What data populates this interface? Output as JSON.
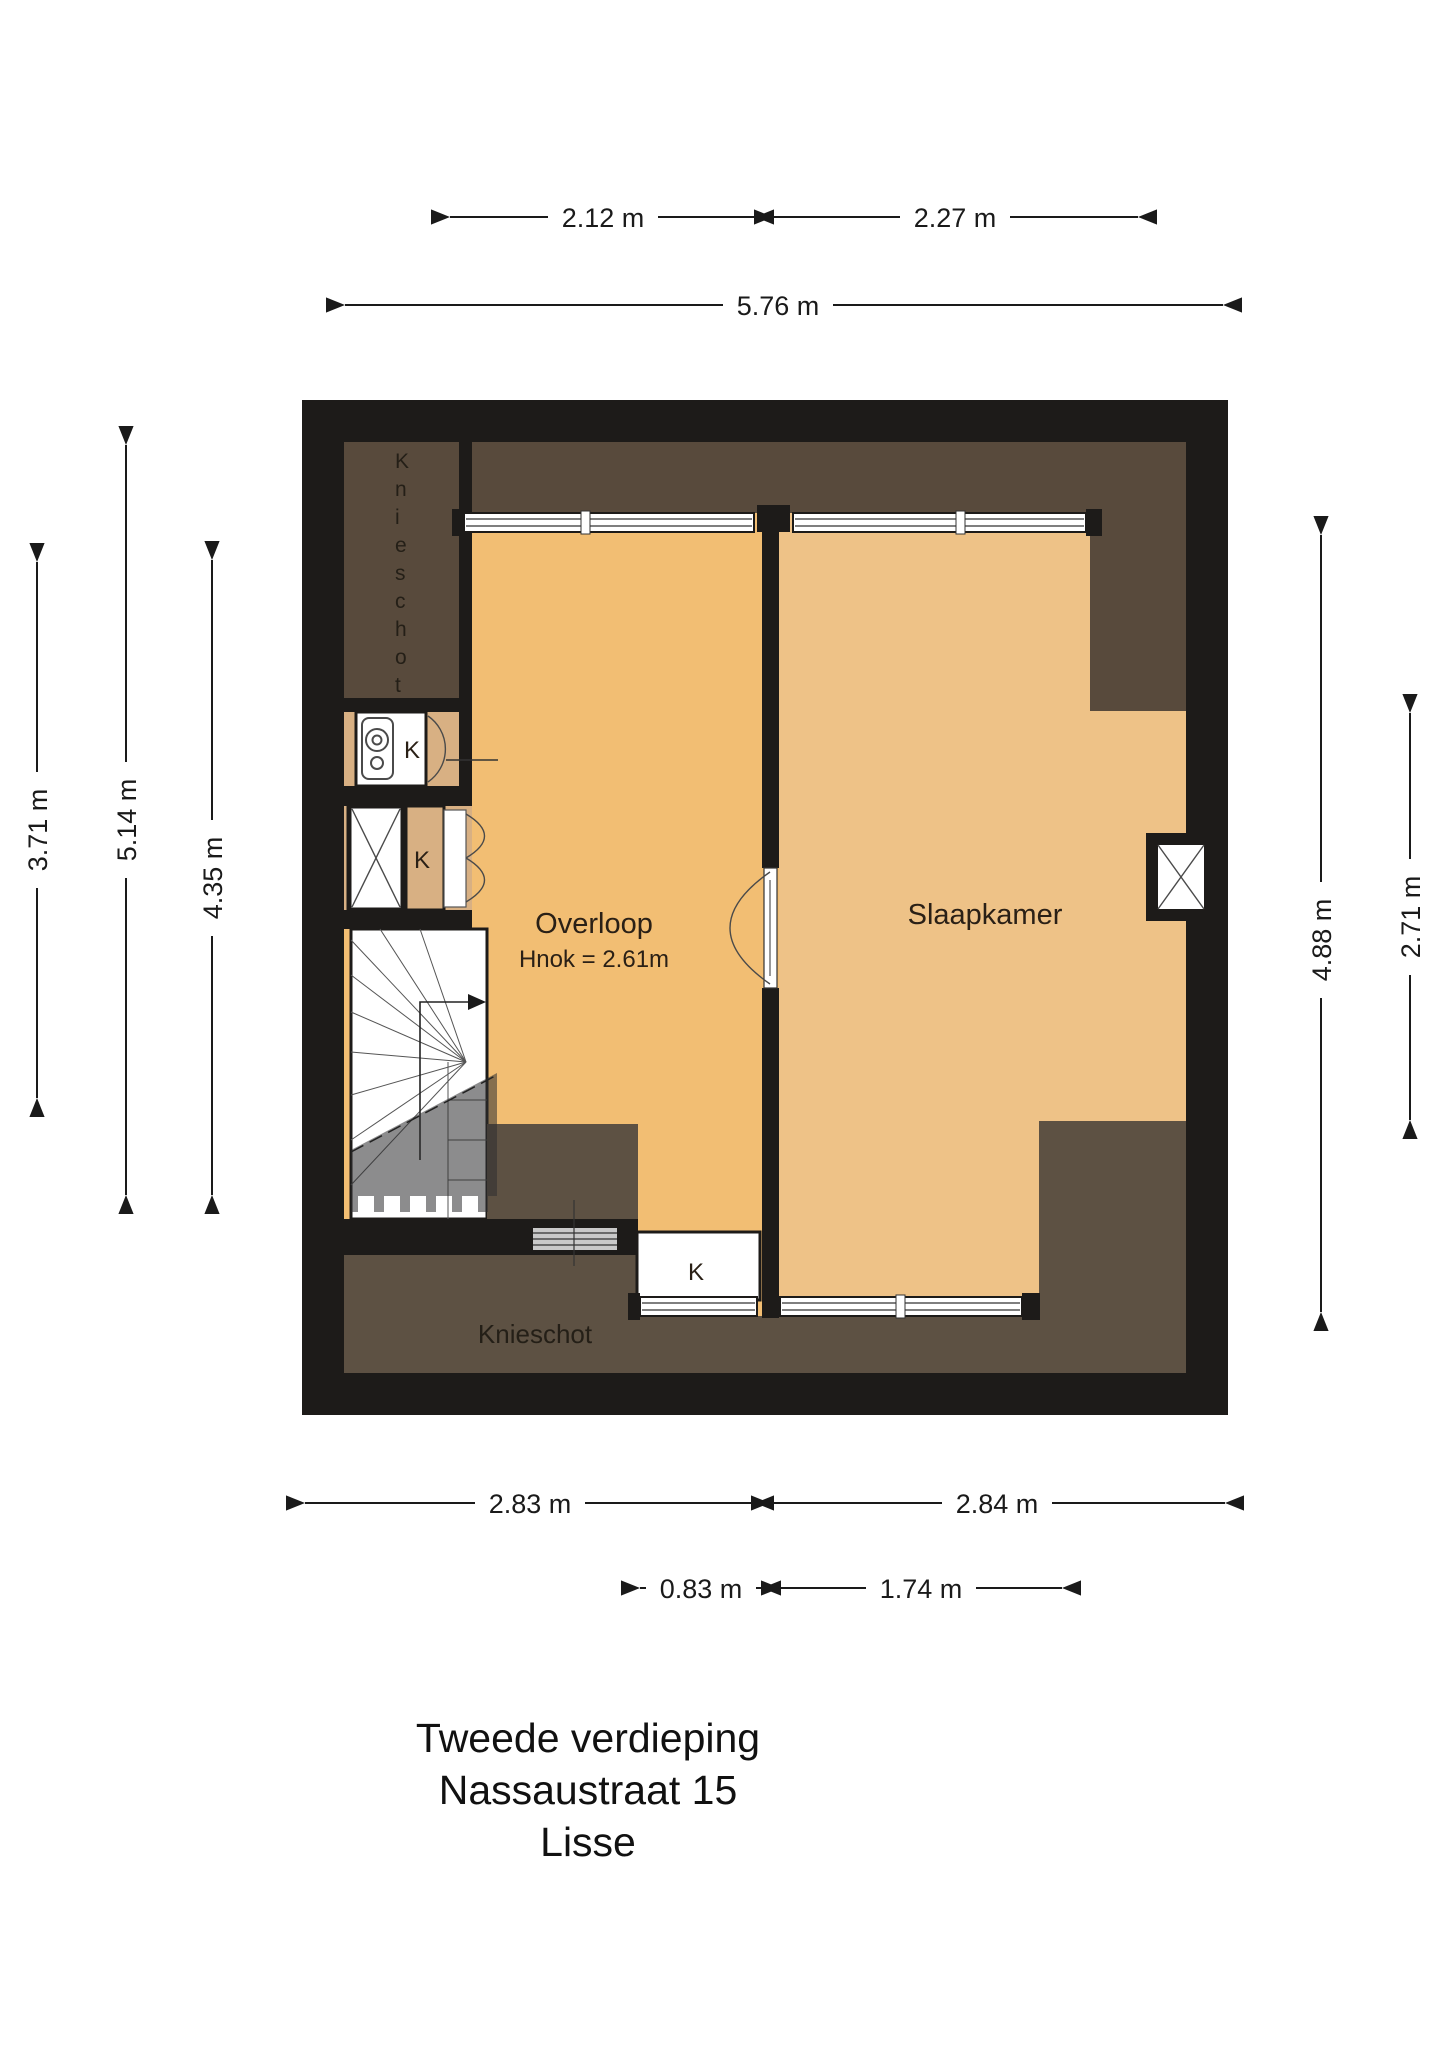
{
  "title": {
    "line1": "Tweede verdieping",
    "line2": "Nassaustraat 15",
    "line3": "Lisse"
  },
  "rooms": {
    "overloop": "Overloop",
    "overloop_note": "Hnok = 2.61m",
    "slaapkamer": "Slaapkamer",
    "knieschot_top_left": "Knieschot",
    "knieschot_bottom": "Knieschot",
    "closet_boiler": "K",
    "closet_left": "K",
    "closet_bottom": "K"
  },
  "dimensions": {
    "top_row_1a": "2.12 m",
    "top_row_1b": "2.27 m",
    "top_row_2": "5.76 m",
    "left_outer": "3.71 m",
    "left_mid": "5.14 m",
    "left_inner": "4.35 m",
    "right_outer": "2.71 m",
    "right_inner": "4.88 m",
    "bottom_row_1a": "2.83 m",
    "bottom_row_1b": "2.84 m",
    "bottom_row_2a": "0.83 m",
    "bottom_row_2b": "1.74 m"
  },
  "colors": {
    "wall": "#1d1b19",
    "floor_overloop": "#f2be73",
    "floor_slaapkamer": "#eec287",
    "roof_space_top": "#584a3c",
    "roof_space_bottom": "#5d5143",
    "closet_tan": "#d8b083",
    "under_stairs_overlay": "rgba(45,45,48,0.55)"
  }
}
